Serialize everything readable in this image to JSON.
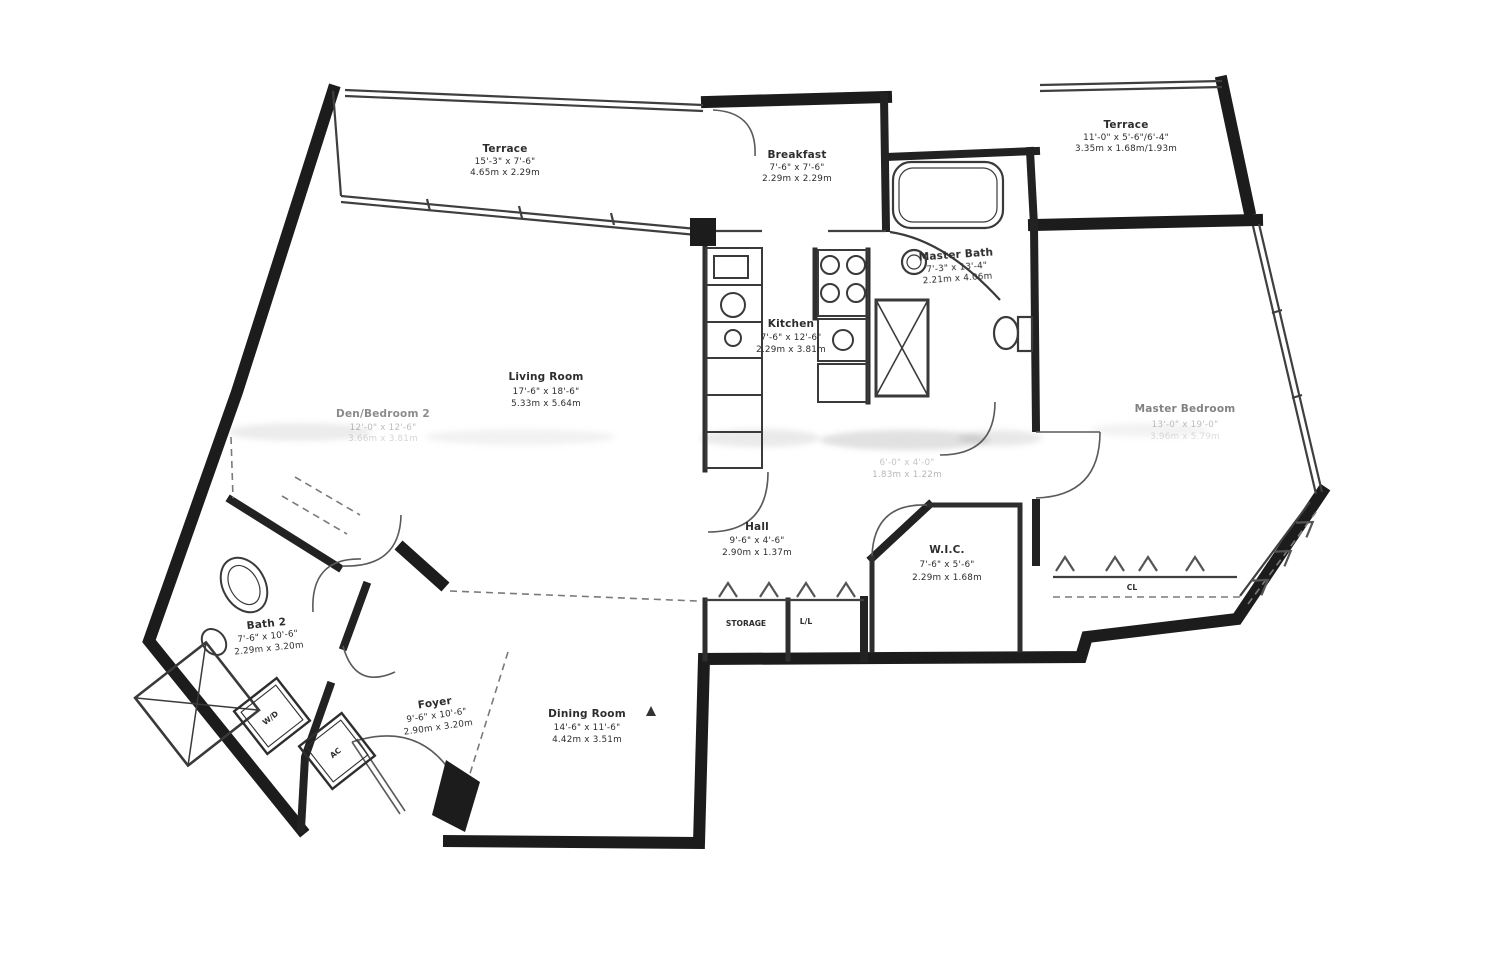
{
  "colors": {
    "ink": "#1c1c1c",
    "line": "#3f3f3f",
    "dash": "#7a7a7a",
    "paper": "#ffffff"
  },
  "rooms": {
    "terrace_left": {
      "name": "Terrace",
      "dims_ft": "15'-3\" x 7'-6\"",
      "dims_m": "4.65m x 2.29m"
    },
    "breakfast": {
      "name": "Breakfast",
      "dims_ft": "7'-6\" x 7'-6\"",
      "dims_m": "2.29m x 2.29m"
    },
    "terrace_right": {
      "name": "Terrace",
      "dims_ft": "11'-0\" x 5'-6\"/6'-4\"",
      "dims_m": "3.35m x 1.68m/1.93m"
    },
    "master_bath": {
      "name": "Master Bath",
      "dims_ft": "7'-3\" x 13'-4\"",
      "dims_m": "2.21m x 4.06m"
    },
    "kitchen": {
      "name": "Kitchen",
      "dims_ft": "7'-6\" x 12'-6\"",
      "dims_m": "2.29m x 3.81m"
    },
    "living_room": {
      "name": "Living Room",
      "dims_ft": "17'-6\" x 18'-6\"",
      "dims_m": "5.33m x 5.64m"
    },
    "bedroom2": {
      "name": "Den/Bedroom 2",
      "dims_ft": "12'-0\" x 12'-6\"",
      "dims_m": "3.66m x 3.81m"
    },
    "master_bedroom": {
      "name": "Master Bedroom",
      "dims_ft": "13'-0\" x 19'-0\"",
      "dims_m": "3.96m x 5.79m"
    },
    "hall": {
      "name": "Hall",
      "dims_ft": "9'-6\" x 4'-6\"",
      "dims_m": "2.90m x 1.37m"
    },
    "wic": {
      "name": "W.I.C.",
      "dims_ft": "7'-6\" x 5'-6\"",
      "dims_m": "2.29m x 1.68m"
    },
    "bath2": {
      "name": "Bath 2",
      "dims_ft": "7'-6\" x 10'-6\"",
      "dims_m": "2.29m x 3.20m"
    },
    "foyer": {
      "name": "Foyer",
      "dims_ft": "9'-6\" x 10'-6\"",
      "dims_m": "2.90m x 3.20m"
    },
    "dining_room": {
      "name": "Dining Room",
      "dims_ft": "14'-6\" x 11'-6\"",
      "dims_m": "4.42m x 3.51m"
    },
    "hall_nook": {
      "name": "",
      "dims_ft": "6'-0\" x 4'-0\"",
      "dims_m": "1.83m x 1.22m"
    }
  },
  "fixtures": {
    "storage": "STORAGE",
    "linen": "L/L",
    "closet": "CL",
    "washer_dryer": "W/D",
    "air_conditioner": "AC"
  }
}
